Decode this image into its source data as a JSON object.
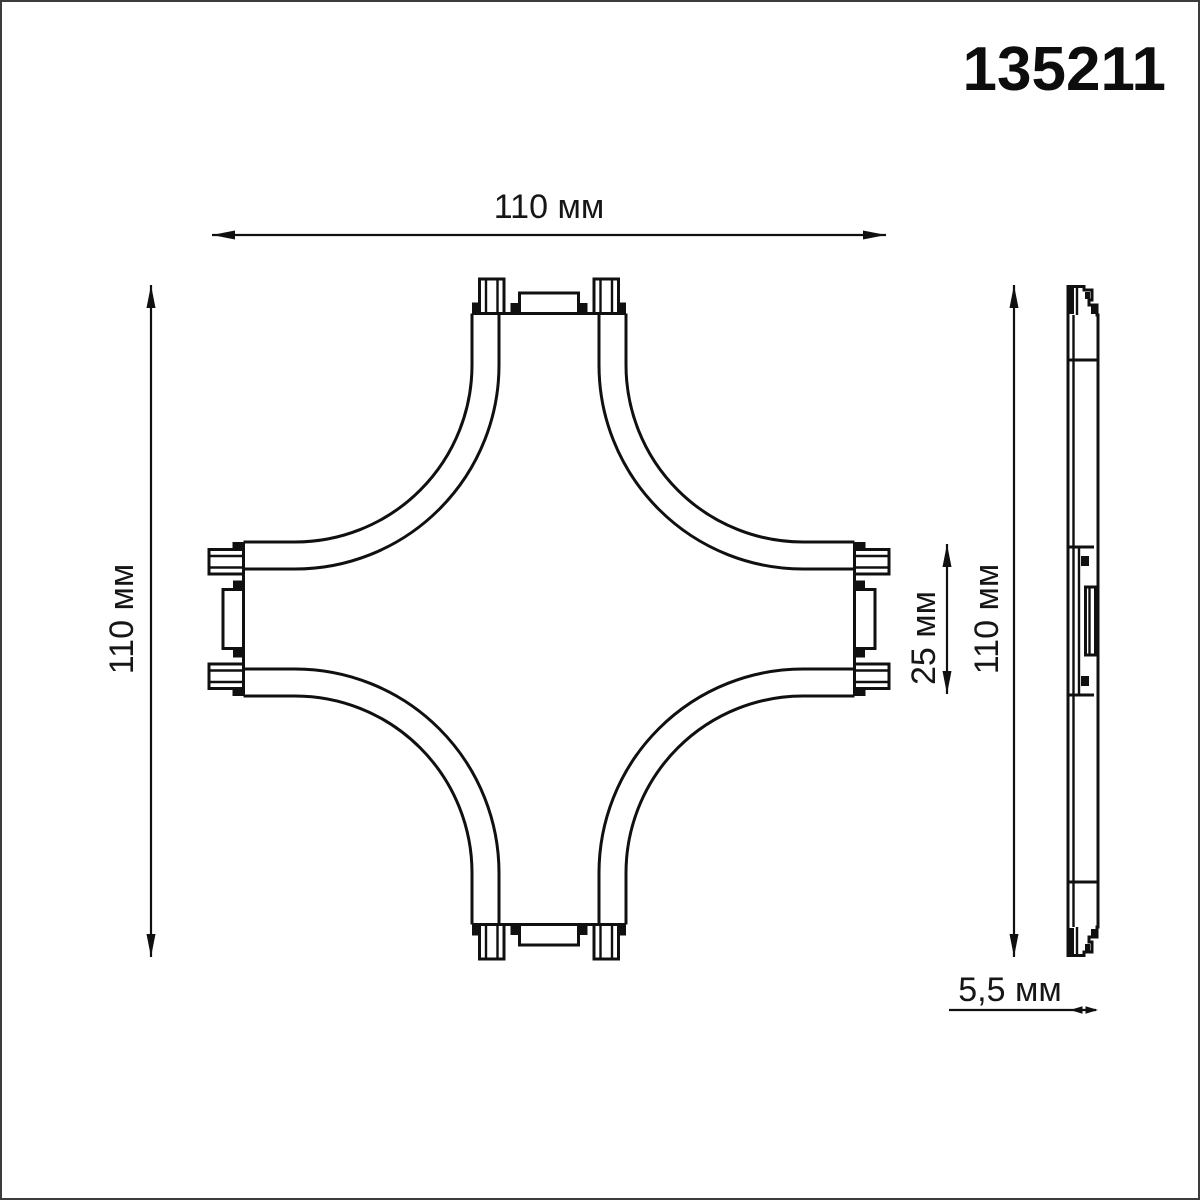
{
  "part_number": "135211",
  "dims": {
    "front_width": "110 мм",
    "front_height": "110 мм",
    "connector_end_width": "25 мм",
    "side_height": "110 мм",
    "side_thickness": "5,5 мм"
  },
  "views": {
    "front": "cross-connector-front-view",
    "side": "cross-connector-side-profile"
  },
  "colors": {
    "line": "#101010",
    "background": "#ffffff",
    "frame_border": "#3c3c3c"
  }
}
